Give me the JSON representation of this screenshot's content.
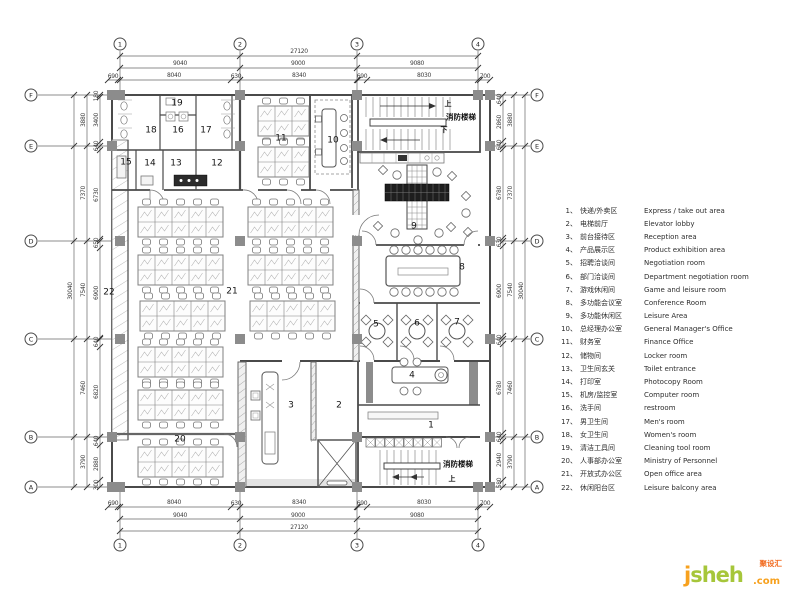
{
  "colors": {
    "wall": "#4a4a4a",
    "column": "#8c8c8c",
    "logo_green": "#a6c63a",
    "logo_orange": "#f7a11e",
    "logo_red": "#f26c21"
  },
  "grid": {
    "bubbles": [
      {
        "label": "1",
        "x": 120,
        "y": 44
      },
      {
        "label": "2",
        "x": 240,
        "y": 44
      },
      {
        "label": "3",
        "x": 357,
        "y": 44
      },
      {
        "label": "4",
        "x": 478,
        "y": 44
      },
      {
        "label": "1",
        "x": 120,
        "y": 545
      },
      {
        "label": "2",
        "x": 240,
        "y": 545
      },
      {
        "label": "3",
        "x": 357,
        "y": 545
      },
      {
        "label": "4",
        "x": 478,
        "y": 545
      },
      {
        "label": "F",
        "x": 31,
        "y": 95
      },
      {
        "label": "E",
        "x": 31,
        "y": 146
      },
      {
        "label": "D",
        "x": 31,
        "y": 241
      },
      {
        "label": "C",
        "x": 31,
        "y": 339
      },
      {
        "label": "B",
        "x": 31,
        "y": 437
      },
      {
        "label": "A",
        "x": 31,
        "y": 487
      },
      {
        "label": "F",
        "x": 537,
        "y": 95
      },
      {
        "label": "E",
        "x": 537,
        "y": 146
      },
      {
        "label": "D",
        "x": 537,
        "y": 241
      },
      {
        "label": "C",
        "x": 537,
        "y": 339
      },
      {
        "label": "B",
        "x": 537,
        "y": 437
      },
      {
        "label": "A",
        "x": 537,
        "y": 487
      }
    ]
  },
  "dimensions": {
    "horizontal": [
      {
        "t": "27120",
        "x": 299,
        "y": 49
      },
      {
        "t": "9040",
        "x": 180,
        "y": 61
      },
      {
        "t": "9000",
        "x": 298,
        "y": 61
      },
      {
        "t": "9080",
        "x": 417,
        "y": 61
      },
      {
        "t": "690",
        "x": 113,
        "y": 74
      },
      {
        "t": "8040",
        "x": 174,
        "y": 73
      },
      {
        "t": "630",
        "x": 236,
        "y": 74
      },
      {
        "t": "8340",
        "x": 299,
        "y": 73
      },
      {
        "t": "690",
        "x": 362,
        "y": 74
      },
      {
        "t": "8030",
        "x": 424,
        "y": 73
      },
      {
        "t": "700",
        "x": 485,
        "y": 74
      },
      {
        "t": "690",
        "x": 113,
        "y": 501
      },
      {
        "t": "8040",
        "x": 174,
        "y": 500
      },
      {
        "t": "630",
        "x": 236,
        "y": 501
      },
      {
        "t": "8340",
        "x": 299,
        "y": 500
      },
      {
        "t": "690",
        "x": 362,
        "y": 501
      },
      {
        "t": "8030",
        "x": 424,
        "y": 500
      },
      {
        "t": "700",
        "x": 485,
        "y": 501
      },
      {
        "t": "9040",
        "x": 180,
        "y": 513
      },
      {
        "t": "9000",
        "x": 298,
        "y": 513
      },
      {
        "t": "9080",
        "x": 417,
        "y": 513
      },
      {
        "t": "27120",
        "x": 299,
        "y": 525
      }
    ],
    "vertical": [
      {
        "t": "30040",
        "x": 71,
        "y": 291
      },
      {
        "t": "3880",
        "x": 84,
        "y": 120
      },
      {
        "t": "7370",
        "x": 84,
        "y": 193
      },
      {
        "t": "7540",
        "x": 84,
        "y": 290
      },
      {
        "t": "7460",
        "x": 84,
        "y": 388
      },
      {
        "t": "3790",
        "x": 84,
        "y": 462
      },
      {
        "t": "180",
        "x": 97,
        "y": 96
      },
      {
        "t": "3400",
        "x": 97,
        "y": 120
      },
      {
        "t": "640",
        "x": 97,
        "y": 146
      },
      {
        "t": "6730",
        "x": 97,
        "y": 195
      },
      {
        "t": "650",
        "x": 97,
        "y": 243
      },
      {
        "t": "6900",
        "x": 97,
        "y": 293
      },
      {
        "t": "640",
        "x": 97,
        "y": 342
      },
      {
        "t": "6820",
        "x": 97,
        "y": 392
      },
      {
        "t": "640",
        "x": 97,
        "y": 441
      },
      {
        "t": "2880",
        "x": 97,
        "y": 464
      },
      {
        "t": "300",
        "x": 97,
        "y": 485
      },
      {
        "t": "640",
        "x": 500,
        "y": 99
      },
      {
        "t": "2860",
        "x": 500,
        "y": 122
      },
      {
        "t": "640",
        "x": 500,
        "y": 145
      },
      {
        "t": "6780",
        "x": 500,
        "y": 193
      },
      {
        "t": "630",
        "x": 500,
        "y": 242
      },
      {
        "t": "6900",
        "x": 500,
        "y": 291
      },
      {
        "t": "640",
        "x": 500,
        "y": 340
      },
      {
        "t": "6780",
        "x": 500,
        "y": 388
      },
      {
        "t": "640",
        "x": 500,
        "y": 437
      },
      {
        "t": "2940",
        "x": 500,
        "y": 460
      },
      {
        "t": "580",
        "x": 500,
        "y": 483
      },
      {
        "t": "3880",
        "x": 511,
        "y": 120
      },
      {
        "t": "7370",
        "x": 511,
        "y": 193
      },
      {
        "t": "7540",
        "x": 511,
        "y": 290
      },
      {
        "t": "7460",
        "x": 511,
        "y": 388
      },
      {
        "t": "3790",
        "x": 511,
        "y": 462
      },
      {
        "t": "30040",
        "x": 522,
        "y": 291
      }
    ]
  },
  "rooms": [
    {
      "n": "1",
      "x": 431,
      "y": 426
    },
    {
      "n": "2",
      "x": 339,
      "y": 406
    },
    {
      "n": "3",
      "x": 291,
      "y": 406
    },
    {
      "n": "4",
      "x": 412,
      "y": 376
    },
    {
      "n": "5",
      "x": 376,
      "y": 325
    },
    {
      "n": "6",
      "x": 417,
      "y": 324
    },
    {
      "n": "7",
      "x": 457,
      "y": 323
    },
    {
      "n": "8",
      "x": 462,
      "y": 268
    },
    {
      "n": "9",
      "x": 414,
      "y": 227
    },
    {
      "n": "10",
      "x": 333,
      "y": 141
    },
    {
      "n": "11",
      "x": 281,
      "y": 139
    },
    {
      "n": "12",
      "x": 217,
      "y": 164
    },
    {
      "n": "13",
      "x": 176,
      "y": 164
    },
    {
      "n": "14",
      "x": 150,
      "y": 164
    },
    {
      "n": "15",
      "x": 126,
      "y": 163
    },
    {
      "n": "16",
      "x": 178,
      "y": 131
    },
    {
      "n": "17",
      "x": 206,
      "y": 131
    },
    {
      "n": "18",
      "x": 151,
      "y": 131
    },
    {
      "n": "19",
      "x": 177,
      "y": 104
    },
    {
      "n": "20",
      "x": 180,
      "y": 440
    },
    {
      "n": "21",
      "x": 232,
      "y": 292
    },
    {
      "n": "22",
      "x": 109,
      "y": 293
    }
  ],
  "stairs": {
    "top": {
      "name": "消防楼梯",
      "up": "上",
      "down": "下"
    },
    "bottom": {
      "name": "消防楼梯",
      "up": "上"
    }
  },
  "legend": {
    "items": [
      {
        "num": "1、",
        "zh": "快递/外卖区",
        "en": "Express / take out area"
      },
      {
        "num": "2、",
        "zh": "电梯前厅",
        "en": "Elevator lobby"
      },
      {
        "num": "3、",
        "zh": "前台接待区",
        "en": "Reception area"
      },
      {
        "num": "4、",
        "zh": "产品展示区",
        "en": "Product exhibition area"
      },
      {
        "num": "5、",
        "zh": "招聘洽谈间",
        "en": "Negotiation room"
      },
      {
        "num": "6、",
        "zh": "部门洽谈间",
        "en": "Department negotiation room"
      },
      {
        "num": "7、",
        "zh": "游戏休闲间",
        "en": "Game and leisure room"
      },
      {
        "num": "8、",
        "zh": "多功能会议室",
        "en": "Conference Room"
      },
      {
        "num": "9、",
        "zh": "多功能休闲区",
        "en": "Leisure Area"
      },
      {
        "num": "10、",
        "zh": "总经理办公室",
        "en": "General Manager's Office"
      },
      {
        "num": "11、",
        "zh": "财务室",
        "en": "Finance Office"
      },
      {
        "num": "12、",
        "zh": "储物间",
        "en": "Locker room"
      },
      {
        "num": "13、",
        "zh": "卫生间玄关",
        "en": "Toilet entrance"
      },
      {
        "num": "14、",
        "zh": "打印室",
        "en": "Photocopy Room"
      },
      {
        "num": "15、",
        "zh": "机房/监控室",
        "en": "Computer room"
      },
      {
        "num": "16、",
        "zh": "洗手间",
        "en": "restroom"
      },
      {
        "num": "17、",
        "zh": "男卫生间",
        "en": "Men's room"
      },
      {
        "num": "18、",
        "zh": "女卫生间",
        "en": "Women's room"
      },
      {
        "num": "19、",
        "zh": "清洁工具间",
        "en": "Cleaning tool room"
      },
      {
        "num": "20、",
        "zh": "人事部办公室",
        "en": "Ministry of Personnel"
      },
      {
        "num": "21、",
        "zh": "开放式办公区",
        "en": "Open office area"
      },
      {
        "num": "22、",
        "zh": "休闲阳台区",
        "en": "Leisure balcony area"
      }
    ]
  },
  "watermark": {
    "j": "j",
    "sheh": "sheh",
    "com": ".com",
    "badge": "聚设汇"
  }
}
